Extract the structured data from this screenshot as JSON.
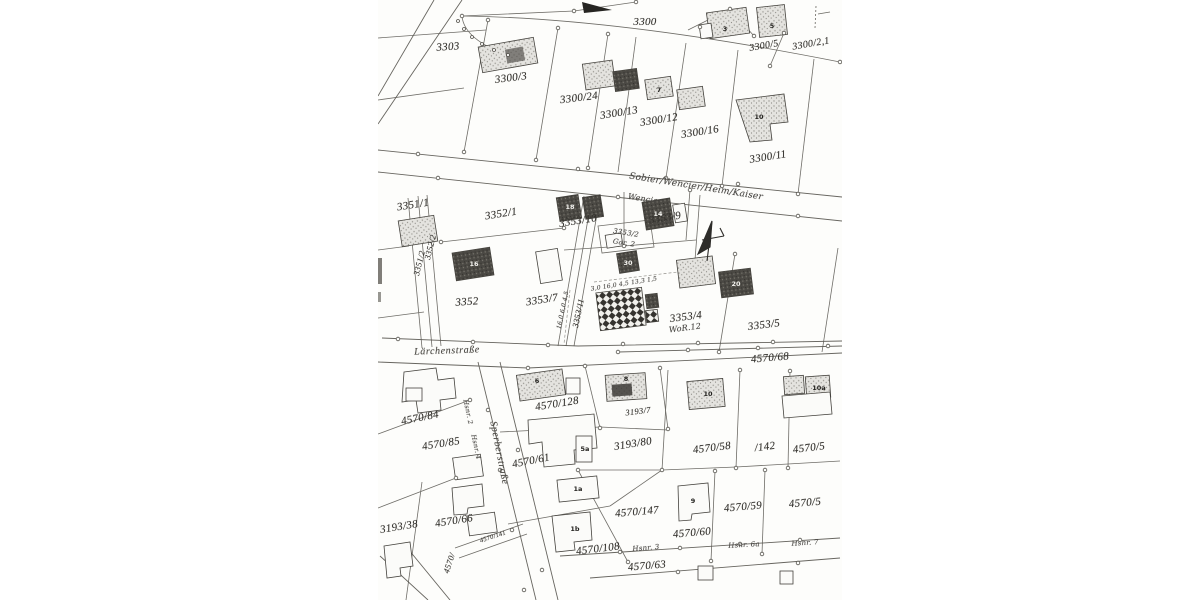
{
  "document": {
    "kind": "Scanned cadastral map (Flurkarte photocopy)",
    "background_color": "#fdfdfb",
    "ink_color": "#57554f"
  },
  "streets": {
    "laerchenstrasse": "Lärchenstraße",
    "sperberstrasse": "Sperberstraße"
  },
  "parcels": {
    "p3300": "3300",
    "p3300_5": "3300/5",
    "p3300_2_1": "3300/2,1",
    "p3303": "3303",
    "p3300_3": "3300/3",
    "p3300_24": "3300/24",
    "p3300_13": "3300/13",
    "p3300_12": "3300/12",
    "p3300_16": "3300/16",
    "p3300_11": "3300/11",
    "p3351_1": "3351/1",
    "p3351_2": "3351/2",
    "p3352_1": "3352/1",
    "p3352_2": "3352/2",
    "p3352": "3352",
    "p3353_10": "3353/10",
    "p3353_9": "3353/9",
    "p3353_7": "3353/7",
    "p3353_11": "3353/11",
    "p3353_4": "3353/4",
    "p3353_5": "3353/5",
    "p4570_68": "4570/68",
    "p4570_84": "4570/84",
    "p4570_85": "4570/85",
    "p4570_128": "4570/128",
    "p3193_7": "3193/7",
    "p3193_80": "3193/80",
    "p4570_58": "4570/58",
    "p142": "/142",
    "p4570_5_upper": "4570/5",
    "p4570_61": "4570/61",
    "p3193_38": "3193/38",
    "p4570_66": "4570/66",
    "p4570_141": "4570/141",
    "p4570_partial": "4570/",
    "p4570_147": "4570/147",
    "p4570_108": "4570/108",
    "p4570_63": "4570/63",
    "p4570_60": "4570/60",
    "p4570_59": "4570/59",
    "p4570_5_lower": "4570/5"
  },
  "annotations": {
    "owners": "Sobier/Wencier/Heim/Kaiser",
    "owner_single": "Wencier",
    "parcel_hw": "3353/2",
    "garage": "Gar. 2",
    "wor": "WoR.12",
    "hsnr2": "Hsnr. 2",
    "hsnr3": "Hsnr. 3",
    "hsnr4": "Hsnr. 4",
    "hsnr6a": "Hsnr. 6a",
    "hsnr7": "Hsnr. 7",
    "measures_top": "3,0  16,0  4,5  13,3  1,5",
    "measures_left": "16,0  6,0  4,5"
  },
  "house_numbers": {
    "hn3": "3",
    "hn5": "5",
    "hn7": "7",
    "hn10": "10",
    "hn16": "16",
    "hn18": "18",
    "hn14": "14",
    "hn30": "30",
    "hn20": "20",
    "hn6": "6",
    "hn8": "8",
    "hn10b": "10",
    "hn10a": "10a",
    "hn1a": "1a",
    "hn1b": "1b",
    "hn9": "9",
    "hn5a": "5a"
  },
  "icons": {
    "north_arrow": "hand-drawn north arrow"
  }
}
